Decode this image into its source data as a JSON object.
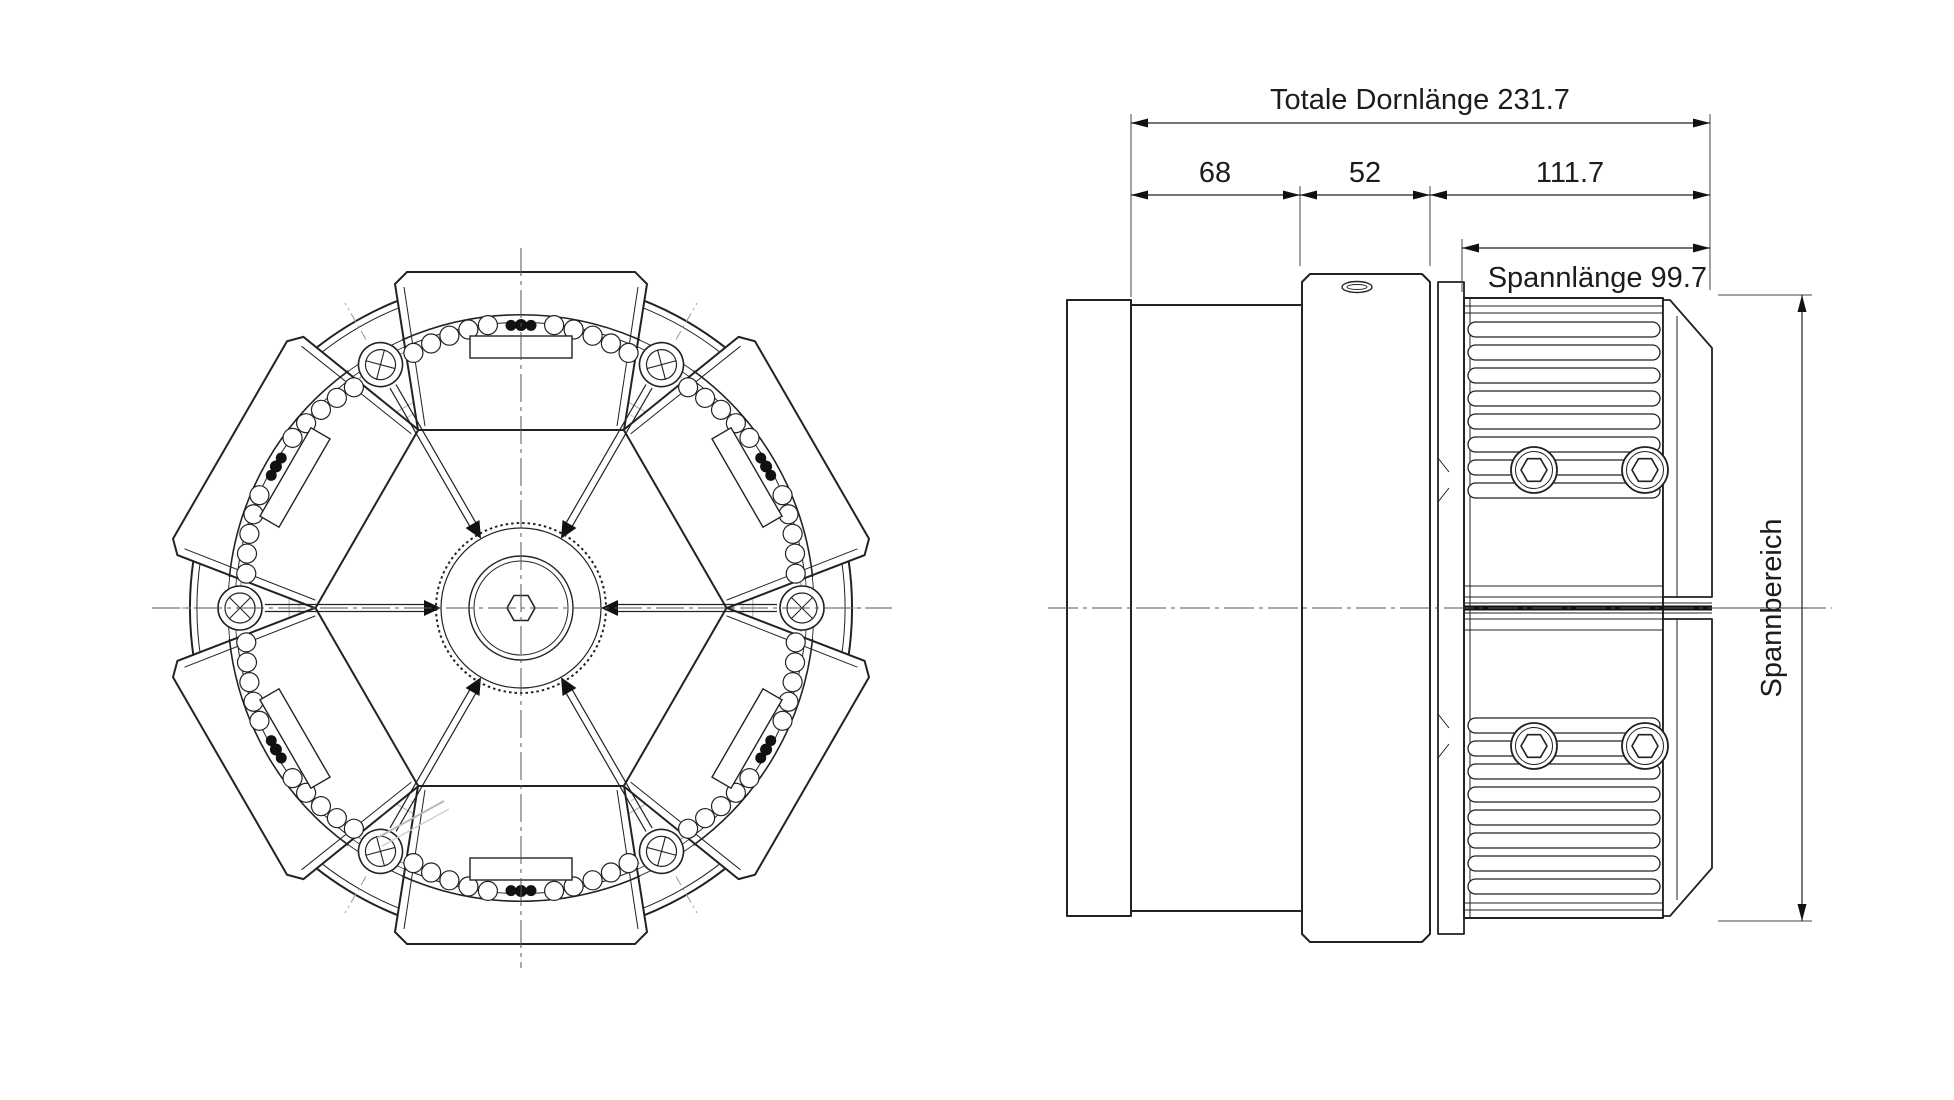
{
  "drawing": {
    "dimensions": {
      "total_length": {
        "label": "Totale Dornlänge 231.7"
      },
      "segment_1": {
        "label": "68"
      },
      "segment_2": {
        "label": "52"
      },
      "segment_3": {
        "label": "111.7"
      },
      "clamp_length": {
        "label": "Spannlänge 99.7"
      },
      "clamp_range": {
        "label": "Spannbereich"
      }
    },
    "colors": {
      "ink": "#222222",
      "centerline": "#555555",
      "faint": "#b8b8b8"
    }
  }
}
